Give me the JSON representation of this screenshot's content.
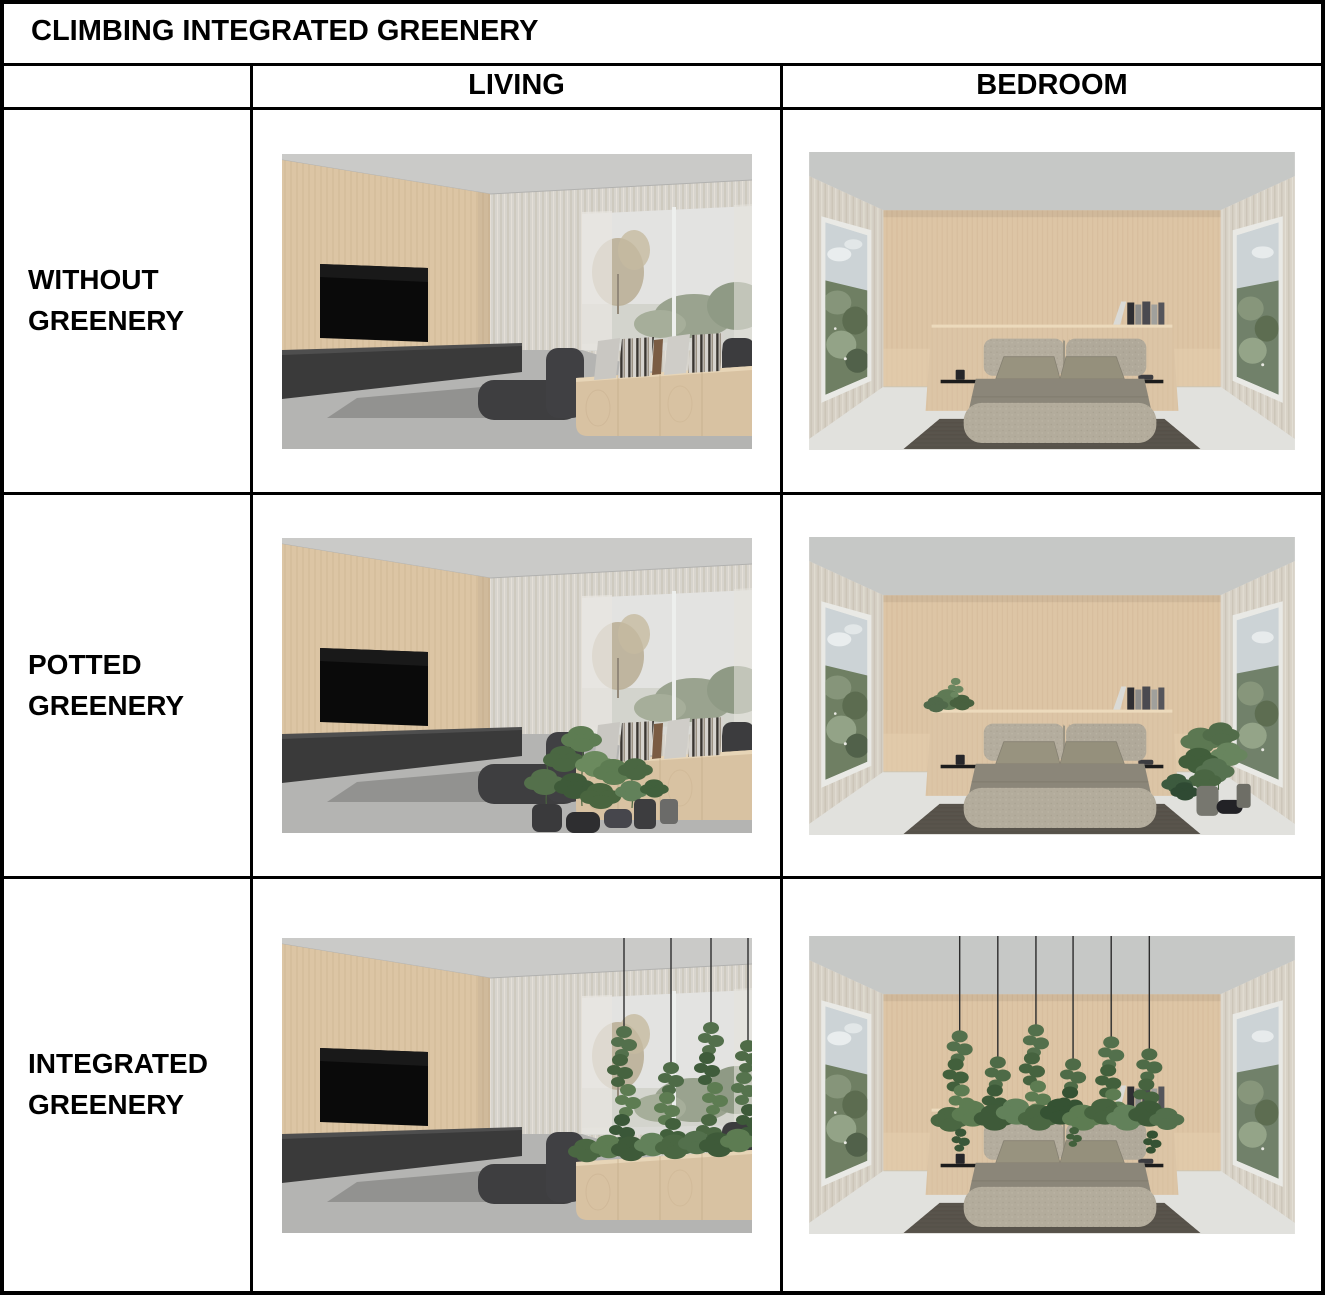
{
  "figure": {
    "title": "CLIMBING INTEGRATED GREENERY",
    "column_headers": [
      "LIVING",
      "BEDROOM"
    ],
    "row_headers": [
      "WITHOUT GREENERY",
      "POTTED GREENERY",
      "INTEGRATED GREENERY"
    ],
    "cells": [
      {
        "row": "WITHOUT GREENERY",
        "column": "LIVING",
        "image": "living-room-render-without-greenery"
      },
      {
        "row": "WITHOUT GREENERY",
        "column": "BEDROOM",
        "image": "bedroom-render-without-greenery"
      },
      {
        "row": "POTTED GREENERY",
        "column": "LIVING",
        "image": "living-room-render-potted-plants"
      },
      {
        "row": "POTTED GREENERY",
        "column": "BEDROOM",
        "image": "bedroom-render-potted-plants"
      },
      {
        "row": "INTEGRATED GREENERY",
        "column": "LIVING",
        "image": "living-room-render-integrated-climbing-greenery"
      },
      {
        "row": "INTEGRATED GREENERY",
        "column": "BEDROOM",
        "image": "bedroom-render-integrated-hanging-greenery"
      }
    ],
    "colors": {
      "border": "#000000",
      "background": "#ffffff",
      "wood_wall": "#dcc5a4",
      "greenery": "#4c6a45",
      "furniture_dark": "#3b3b3b"
    }
  }
}
